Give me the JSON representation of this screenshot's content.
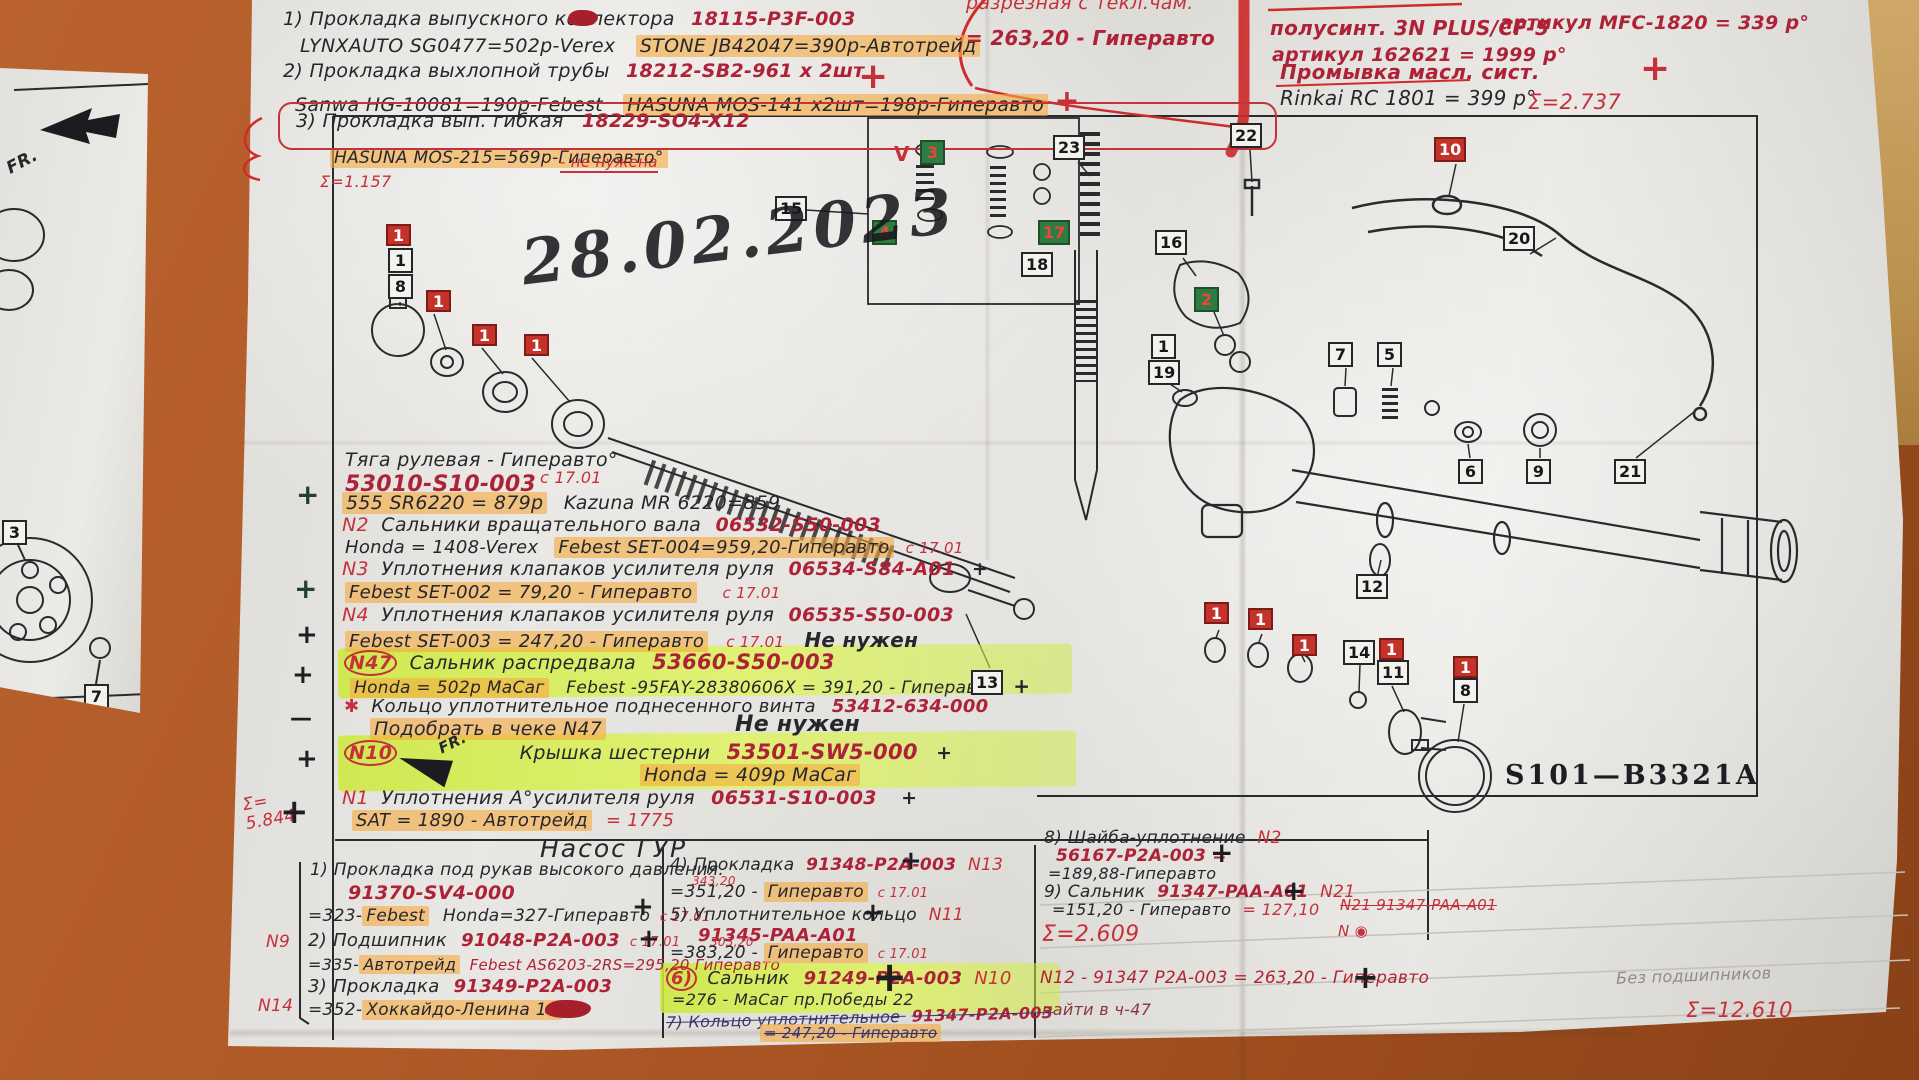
{
  "page": {
    "date_stamp": "28.02.2023",
    "fr": "FR."
  },
  "marks": {
    "plus": "+",
    "minus": "—"
  },
  "exhaust": {
    "i1": "1) Прокладка выпускного коллектора",
    "i1_pn": "18115-P3F-003",
    "i1_a": "LYNXAUTO SG0477=502р-Verex",
    "i1_b": "STONE JB42047=390р-Автотрейд",
    "i2": "2) Прокладка выхлопной трубы",
    "i2_pn": "18212-SB2-961 х 2шт",
    "i2_a": "Sanwa HG-10081=190р-Febest",
    "i2_b": "HASUNA MOS-141 х2шт=198р-Гиперавто",
    "i3": "3) Прокладка вып. гибкая",
    "i3_pn": "18229-SO4-X12",
    "i3_a": "HASUNA MOS-215=569р-Гиперавто°",
    "i3_note": "- не нужена",
    "sum": "Σ=1.157"
  },
  "top_right": {
    "cut_note": "разрезная с текл.чам.",
    "price": "= 263,20 - Гиперавто",
    "r1a": "полусинт. 3N PLUS/CF-5",
    "r1b": "артикул MFC-1820 = 339 р°",
    "r2": "артикул 162621 = 1999 р°",
    "r3": "Промывка масл. сист.",
    "r4": "Rinkai RC 1801 = 399 р°",
    "sum": "Σ=2.737"
  },
  "steering": {
    "title": "Тяга рулевая - Гиперавто°",
    "title_date": "с 17.01",
    "pn": "53010-S10-003",
    "l3a": "555 SR6220 = 879р",
    "l3b": "Kazuna MR 6220=859",
    "n2": "N2",
    "l4": "Сальники вращательного вала",
    "l4pn": "06532-S50-003",
    "l5a": "Honda = 1408-Verex",
    "l5b": "Febest SET-004=959,20-Гиперавто",
    "l5c": "с 17.01",
    "n3": "N3",
    "l6": "Уплотнения клапаков усилителя руля",
    "l6pn": "06534-S84-A01",
    "l7a": "Febest SET-002 = 79,20 - Гиперавто",
    "l7b": "с 17.01",
    "n4": "N4",
    "l8": "Уплотнения клапаков усилителя руля",
    "l8pn": "06535-S50-003",
    "l9a": "Febest SET-003 = 247,20 - Гиперавто",
    "l9b": "с 17.01",
    "l9c": "Не нужен",
    "n47": "N47",
    "l10": "Сальник распредвала",
    "l10pn": "53660-S50-003",
    "l11a": "Honda = 502р МаСаг",
    "l11b": "Febest -95FAY-28380606X = 391,20 - Гиперавто",
    "star": "✱",
    "l12": "Кольцо уплотнительное поднесенного винта",
    "l12pn": "53412-634-000",
    "l13": "Подобрать в чеке N47",
    "l13b": "Не нужен",
    "n10": "N10",
    "l14": "Крышка шестерни",
    "l14pn": "53501-SW5-000",
    "l15": "Honda = 409р МаСаг",
    "n1": "N1",
    "l16": "Уплотнения А°усилителя руля",
    "l16pn": "06531-S10-003",
    "l17a": "SAT = 1890 - Автотрейд",
    "l17b": "= 1775",
    "sum_label": "Σ=",
    "sum_value": "5.844"
  },
  "pump": {
    "header": "Насос ГУР",
    "c1_1": "1) Прокладка под рукав высокого давления.",
    "c1_1pn": "91370-SV4-000",
    "c1_2a": "=323-",
    "c1_2b": "Febest",
    "c1_2c": "Honda=327-Гиперавто",
    "c1_2d": "с 17.01",
    "n9": "N9",
    "c1_3a": "2) Подшипник",
    "c1_3pn": "91048-P2A-003",
    "c1_3b": "с 17.01",
    "c1_4a": "=335-",
    "c1_4b": "Автотрейд",
    "c1_4c": "Febest AS6203-2RS=295,20 Гиперавто",
    "c1_5a": "3) Прокладка",
    "c1_5pn": "91349-P2A-003",
    "n14": "N14",
    "c1_6a": "=352-",
    "c1_6b": "Хоккайдо-Ленина 1а",
    "c2_1a": "4) Прокладка",
    "c2_1pn": "91348-P2A-003",
    "c2_1b": "N13",
    "c2_1c": "343,20",
    "c2_2a": "=351,20 -",
    "c2_2b": "Гиперавто",
    "c2_2c": "с 17.01",
    "c2_3a": "5) Уплотнительное кольцо",
    "c2_3b": "N11",
    "c2_3pn": "91345-PAA-A01",
    "c2_4c": "303,20",
    "c2_4a": "=383,20 -",
    "c2_4b": "Гиперавто",
    "c2_4d": "с 17.01",
    "c2_5a": "6)",
    "c2_5b": "Сальник",
    "c2_5pn": "91249-P2A-003",
    "c2_5c": "N10",
    "c2_6": "=276 - МаСаг пр.Победы 22",
    "c2_7a": "7) Кольцо уплотнительное",
    "c2_7pn": "91347-P2A-003",
    "c2_8": "= 247,20 - Гиперавто",
    "c3_1a": "8) Шайба-уплотнение",
    "c3_1b": "N2",
    "c3_1pn": "56167-P2A-003 =",
    "c3_2": "=189,88-Гиперавто",
    "c3_3a": "9) Сальник",
    "c3_3pn": "91347-PAA-A01",
    "c3_3b": "N21",
    "c3_4a": "=151,20 - Гиперавто",
    "c3_4b": "= 127,10",
    "c3_strike": "N21 91347-PAA-A01",
    "c3_mark": "N ◉",
    "sum1": "Σ=2.609",
    "c3_5": "N12 - 91347 P2A-003 = 263,20 - Гиперавто",
    "c3_6": "найти в ч-47",
    "note": "Без подшипников",
    "sum2": "Σ=12.610"
  },
  "diagram": {
    "code": "S101—B3321A",
    "callouts": {
      "c15": "15",
      "c23": "23",
      "c22": "22",
      "c10": "10",
      "c16": "16",
      "c20": "20",
      "c2": "2",
      "c1": "1",
      "c19": "19",
      "c7": "7",
      "c5": "5",
      "c6": "6",
      "c9": "9",
      "c21": "21",
      "c12": "12",
      "c13": "13",
      "c14": "14",
      "c11": "11",
      "c8": "8",
      "c18": "18",
      "g3": "3",
      "g4": "4",
      "g17": "17",
      "v": "V",
      "one": "1",
      "frag3": "3",
      "frag7": "7"
    }
  }
}
